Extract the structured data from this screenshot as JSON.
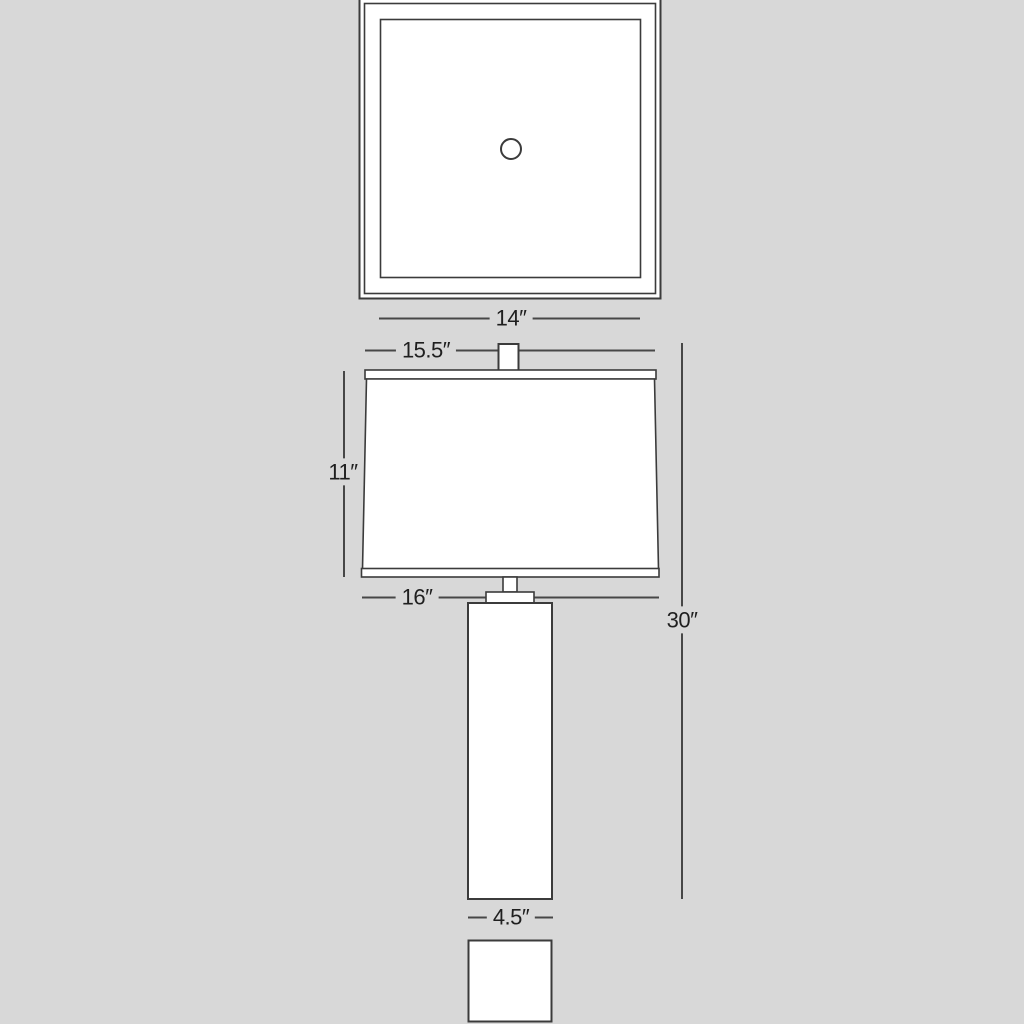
{
  "drawing": {
    "kind": "lamp-dimension-diagram",
    "views": {
      "top_view": "shade plan view with finial hole",
      "front_view": "lamp elevation with shade, neck, column body and base plan"
    }
  },
  "colors": {
    "background": "#d8d8d8",
    "line": "#3b3b3b",
    "dimension_line": "#474747",
    "fill": "#ffffff",
    "text": "#1f1f1f"
  },
  "dimensions": {
    "d14": {
      "label": "14″"
    },
    "d15_5": {
      "label": "15.5″"
    },
    "d11": {
      "label": "11″"
    },
    "d16": {
      "label": "16″"
    },
    "d30": {
      "label": "30″"
    },
    "d4_5": {
      "label": "4.5″"
    }
  }
}
